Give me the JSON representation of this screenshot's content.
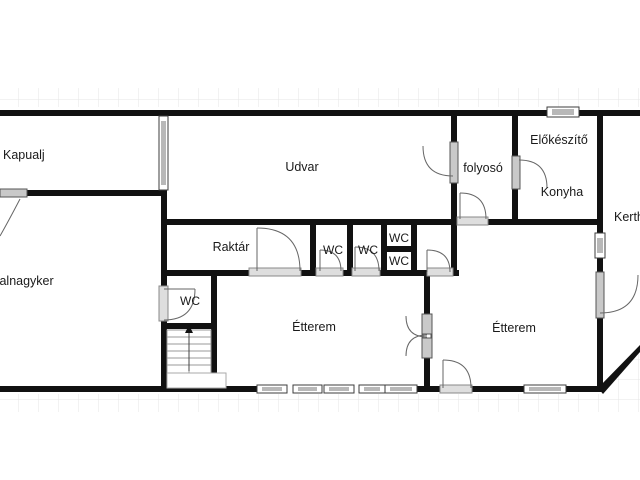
{
  "title": "Floor plan",
  "rooms": {
    "kapualj": {
      "label": "Kapualj"
    },
    "udvar": {
      "label": "Udvar"
    },
    "folyoso": {
      "label": "folyosó"
    },
    "elokeszito": {
      "label": "Előkészítő"
    },
    "konyha": {
      "label": "Konyha"
    },
    "kert": {
      "label": "Kerth"
    },
    "raktar": {
      "label": "Raktár"
    },
    "wc_row_1": {
      "label": "WC"
    },
    "wc_row_2": {
      "label": "WC"
    },
    "wc_stack_top": {
      "label": "WC"
    },
    "wc_stack_bottom": {
      "label": "WC"
    },
    "wc_left": {
      "label": "WC"
    },
    "talnagyker": {
      "label": "talnagyker"
    },
    "etterem_left": {
      "label": "Étterem"
    },
    "etterem_right": {
      "label": "Étterem"
    }
  },
  "colors": {
    "wall": "#111111",
    "grid_line": "#e6e6e6",
    "window_bar": "#b8b8b8",
    "door_bar": "#cccccc",
    "swing_line": "#666666",
    "label_text": "#1a1a1a"
  }
}
